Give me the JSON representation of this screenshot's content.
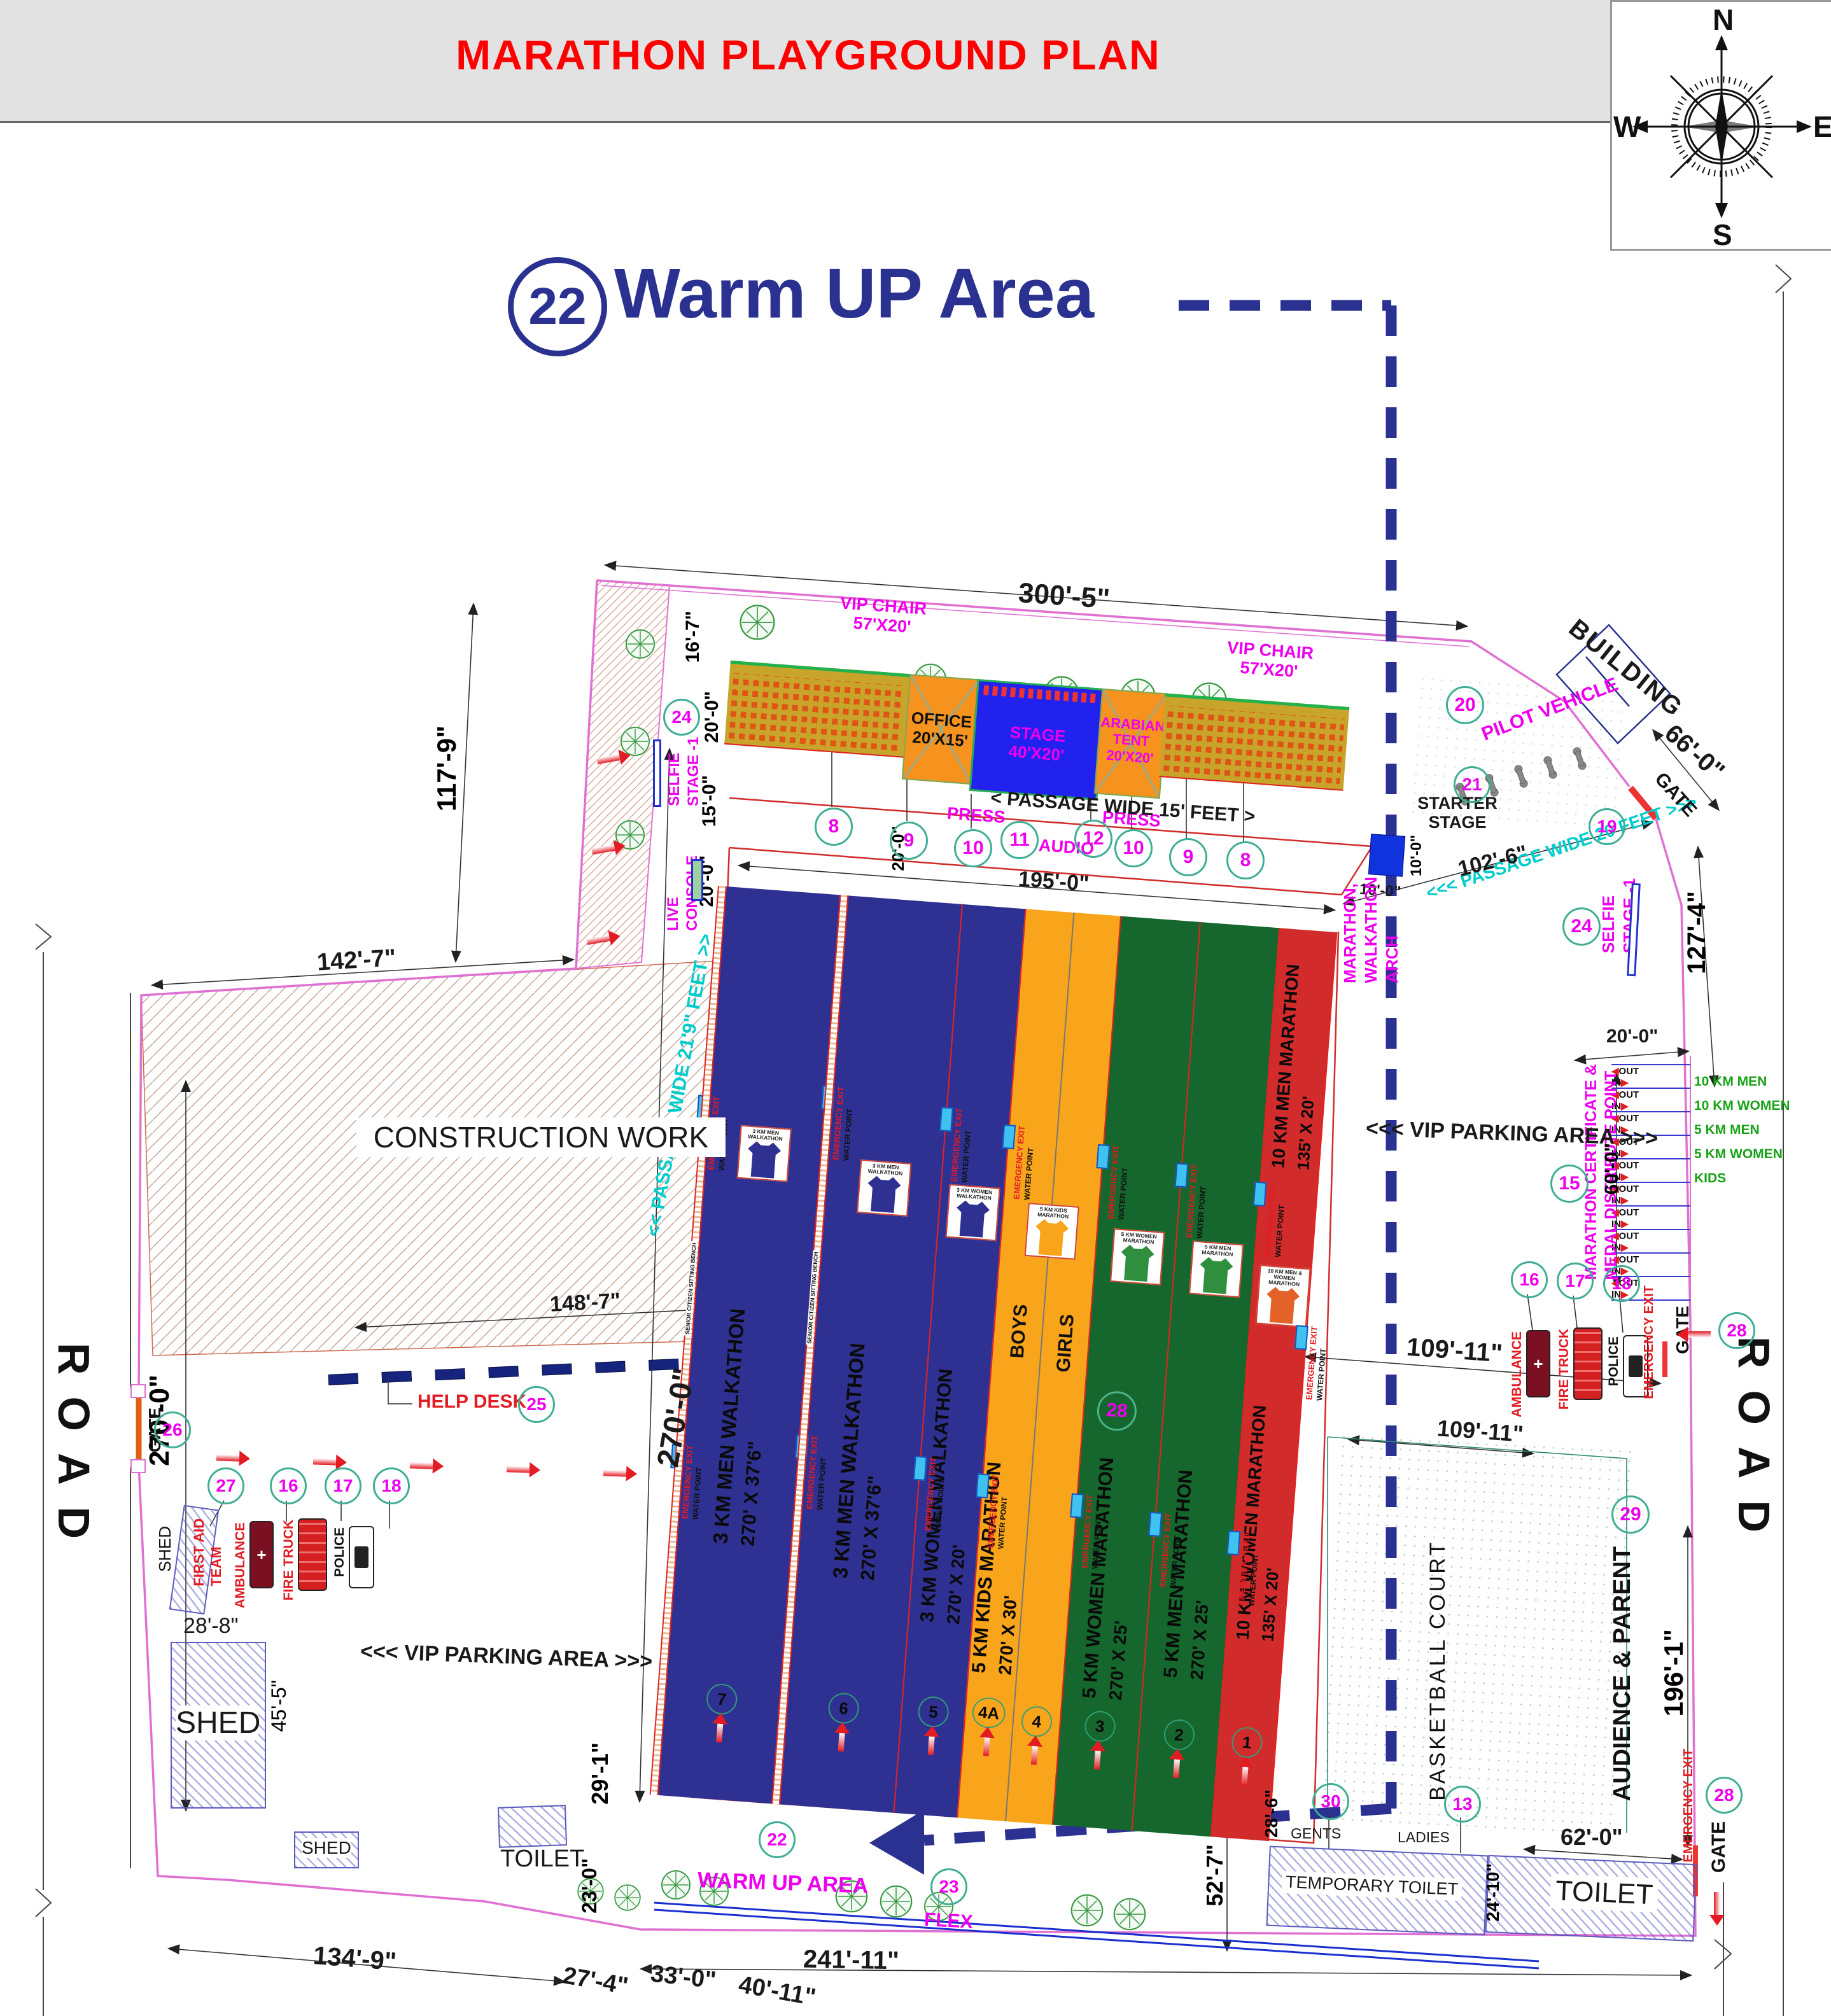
{
  "header": {
    "title": "MARATHON PLAYGROUND PLAN"
  },
  "compass": {
    "north": "N",
    "south": "S",
    "east": "E",
    "west": "W"
  },
  "warmup_callout": {
    "number": "22",
    "label": "Warm UP Area"
  },
  "colors": {
    "navy": "#2b3190",
    "lane_blue": "#2e3192",
    "lane_orange": "#f9a51b",
    "lane_green": "#15672d",
    "lane_red": "#d22b2b",
    "boundary_pink": "#e070d2",
    "accent_magenta": "#ee00ee",
    "accent_red": "#e31b23",
    "gold": "#c9a42b",
    "stage_blue": "#2222ee",
    "tent_orange": "#f6921e",
    "circle_teal": "#3fae95",
    "cyan": "#00cccc",
    "green_text": "#17a317"
  },
  "labels": {
    "road": "ROAD",
    "gate": "GATE",
    "building": "BUILDING",
    "construction": "CONSTRUCTION WORK",
    "shed": "SHED",
    "toilet": "TOILET",
    "temporary_toilet": "TEMPORARY TOILET",
    "gents": "GENTS",
    "ladies": "LADIES",
    "vip_parking": "<<< VIP PARKING AREA >>>",
    "basketball": "BASKETBALL COURT",
    "audience_parent": "AUDIENCE & PARENT",
    "in": "IN",
    "out": "OUT",
    "boys": "BOYS",
    "girls": "GIRLS",
    "press": "PRESS",
    "audio": "AUDIO",
    "flex": "FLEX",
    "warm_up_area": "WARM UP AREA",
    "help_desk": "HELP DESK",
    "live1": "LIVE",
    "live2": "CONSOLE",
    "selfie1": "SELFIE",
    "selfie2": "STAGE -1",
    "pilot_vehicle": "PILOT VEHICLE",
    "first_aid1": "FIRST AID",
    "first_aid2": "TEAM",
    "ambulance": "AMBULANCE",
    "fire_truck": "FIRE TRUCK",
    "police": "POLICE",
    "arch1": "MARATHON,",
    "arch2": "WALKATHON",
    "arch3": "ARCH",
    "emergency_exit": "EMERGENCY EXIT",
    "water_point": "WATER POINT",
    "senior_bench": "SENIOR CITIZEN SITTING BENCH",
    "passage15": "< PASSAGE WIDE 15' FEET >",
    "passage219": "<< PASSAGE WIDE 21'9\" FEET >>",
    "passage20": "<<< PASSAGE WIDE 20 FEET >>>"
  },
  "numbers": {
    "vip_chair": "8",
    "office": "9",
    "press": "10",
    "audio": "11",
    "stage": "12",
    "toilet": "13",
    "certificate": "15",
    "ambulance": "16",
    "fire_truck": "17",
    "police": "18",
    "gate_ne": "19",
    "pilot_vehicle": "20",
    "starter_stage": "21",
    "warm_up": "22",
    "flex": "23",
    "selfie_stage": "24",
    "help_desk": "25",
    "gate_west": "26",
    "first_aid": "27",
    "gate_east": "28",
    "audience": "29",
    "temp_toilet": "30"
  },
  "facilities": {
    "vip_chair": {
      "name": "VIP CHAIR",
      "size": "57'X20'"
    },
    "office": {
      "name": "OFFICE",
      "size": "20'X15'"
    },
    "stage": {
      "name": "STAGE",
      "size": "40'X20'"
    },
    "arabian_tent": {
      "name": "ARABIAN",
      "name2": "TENT",
      "size": "20'X20'"
    },
    "starter_stage": {
      "line1": "STARTER",
      "line2": "STAGE"
    }
  },
  "lanes": [
    {
      "num": "7",
      "name": "3 KM MEN WALKATHON",
      "size": "270' X 37'6\"",
      "jersey": "3 KM MEN WALKATHON"
    },
    {
      "num": "6",
      "name": "3 KM MEN WALKATHON",
      "size": "270' X 37'6\"",
      "jersey": "3 KM MEN WALKATHON"
    },
    {
      "num": "5",
      "name": "3 KM WOMEN WALKATHON",
      "size": "270' X 20'",
      "jersey": "3 KM WOMEN WALKATHON"
    },
    {
      "num": "4A",
      "name": "5 KM KIDS MARATHON",
      "size": "270' X 30'",
      "jersey": "5 KM KIDS MARATHON",
      "group": "BOYS"
    },
    {
      "num": "4",
      "group": "GIRLS"
    },
    {
      "num": "3",
      "name": "5 KM WOMEN MARATHON",
      "size": "270' X 25'",
      "jersey": "5 KM WOMEN MARATHON"
    },
    {
      "num": "2",
      "name": "5 KM MEN MARATHON",
      "size": "270' X 25'",
      "jersey": "5 KM MEN MARATHON"
    },
    {
      "num": "1",
      "name": "10 KM MEN MARATHON",
      "size": "135' X 20'",
      "name2": "10 KM WOMEN MARATHON",
      "size2": "135' X 20'",
      "jersey": "10 KM MEN & WOMEN MARATHON"
    }
  ],
  "certificate": {
    "title1": "MARATHON CERTIFICATE &",
    "title2": "MEDAL DISTRIBUTE POINT",
    "categories": [
      "10 KM MEN",
      "10 KM WOMEN",
      "5 KM MEN",
      "5 KM WOMEN",
      "KIDS"
    ]
  },
  "dims": {
    "w300": "300'-5\"",
    "h16_7": "16'-7\"",
    "w20a": "20'-0\"",
    "w15": "15'-0\"",
    "w20b": "20'-0\"",
    "w195": "195'-0\"",
    "w20lane": "20'-0\"",
    "d102": "102'-6\"",
    "d66": "66'-0\"",
    "d127": "127'-4\"",
    "d117": "117'-9\"",
    "d142": "142'-7\"",
    "d270track": "270'-0\"",
    "d270road": "270'-0\"",
    "d148": "148'-7\"",
    "d28_8": "28'-8\"",
    "d45_5": "45'-5\"",
    "d29_1": "29'-1\"",
    "d23_0": "23'-0\"",
    "d134_9": "134'-9\"",
    "d27_4": "27'-4\"",
    "d33_0": "33'-0\"",
    "d40_11": "40'-11\"",
    "d241_11": "241'-11\"",
    "d52_7": "52'-7\"",
    "d28_6": "28'-6\"",
    "d62": "62'-0\"",
    "d24_10": "24'-10\"",
    "d109a": "109'-11\"",
    "d109b": "109'-11\"",
    "d20cert": "20'-0\"",
    "d60cert": "60'-0\"",
    "d10a": "10'-0\"",
    "d10b": "10'-0\"",
    "d196": "196'-1\""
  }
}
